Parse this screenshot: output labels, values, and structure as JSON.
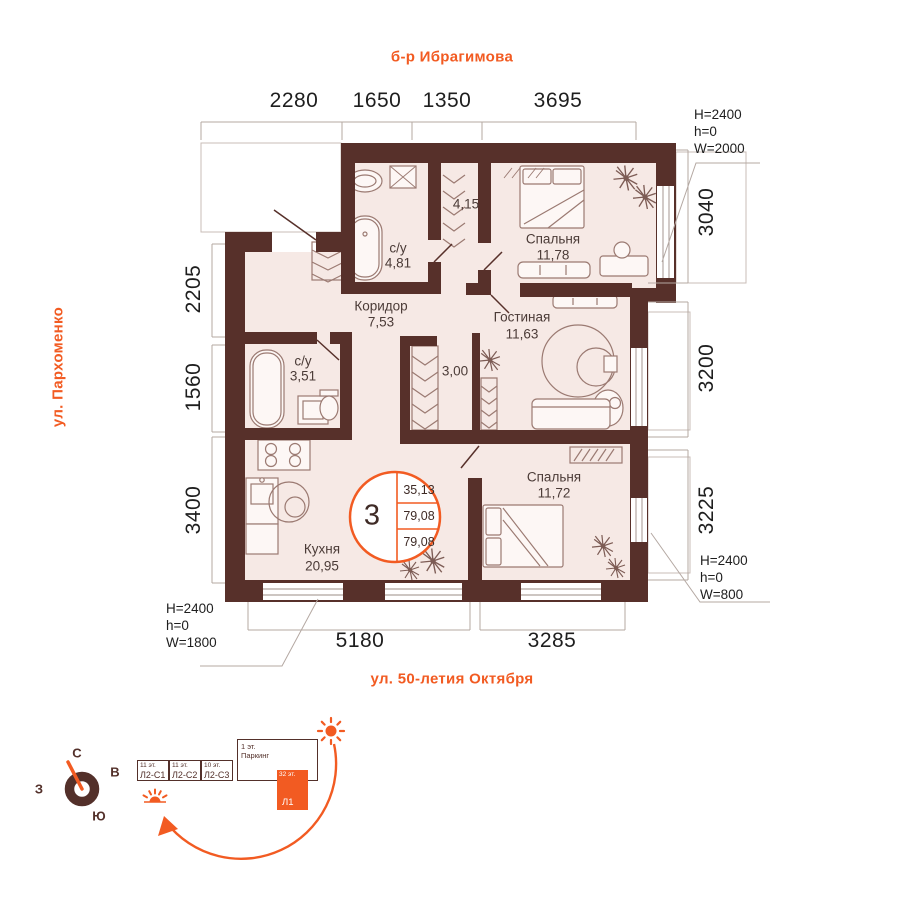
{
  "streets": {
    "top": "б-р Ибрагимова",
    "left": "ул. Пархоменко",
    "bottom": "ул. 50-летия Октября"
  },
  "dims": {
    "top": [
      "2280",
      "1650",
      "1350",
      "3695"
    ],
    "right": [
      "3040",
      "3200",
      "3225"
    ],
    "left": [
      "2205",
      "1560",
      "3400"
    ],
    "bottom": [
      "5180",
      "3285"
    ]
  },
  "window_annotations": {
    "right_top": {
      "l1": "H=2400",
      "l2": "h=0",
      "l3": "W=2000"
    },
    "right_bottom": {
      "l1": "H=2400",
      "l2": "h=0",
      "l3": "W=800"
    },
    "bottom_left": {
      "l1": "H=2400",
      "l2": "h=0",
      "l3": "W=1800"
    }
  },
  "rooms": {
    "bath1": {
      "name": "с/у",
      "area": "4,81"
    },
    "closet1": {
      "area": "4,15"
    },
    "bedroom1": {
      "name": "Спальня",
      "area": "11,78"
    },
    "hall": {
      "name": "Коридор",
      "area": "7,53"
    },
    "living": {
      "name": "Гостиная",
      "area": "11,63"
    },
    "bath2": {
      "name": "с/у",
      "area": "3,51"
    },
    "closet2": {
      "area": "3,00"
    },
    "kitchen": {
      "name": "Кухня",
      "area": "20,95"
    },
    "bedroom2": {
      "name": "Спальня",
      "area": "11,72"
    }
  },
  "stamp": {
    "rooms": "3",
    "values": [
      "35,13",
      "79,08",
      "79,08"
    ]
  },
  "compass": {
    "north": "С",
    "east": "В",
    "south": "Ю",
    "west": "З"
  },
  "scheme": {
    "sections": [
      {
        "floors": "11 эт.",
        "label": "Л2-С1"
      },
      {
        "floors": "11 эт.",
        "label": "Л2-С2"
      },
      {
        "floors": "10 эт.",
        "label": "Л2-С3"
      }
    ],
    "parking": {
      "floors": "1 эт.",
      "label": "Паркинг"
    },
    "tower": {
      "floors": "32 эт.",
      "label": "Л1"
    }
  },
  "colors": {
    "wall": "#57302a",
    "floor": "#f6e9e5",
    "accent": "#f25b22",
    "furniture": "#9b7a72"
  }
}
